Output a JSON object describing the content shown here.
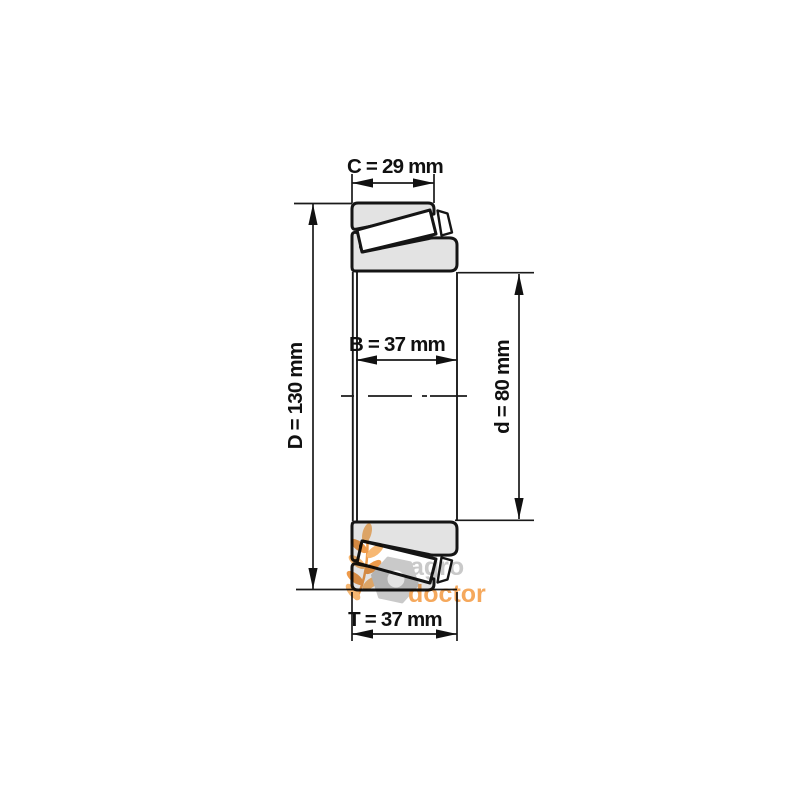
{
  "diagram": {
    "kind": "bearing-cross-section-drawing",
    "dimensions": [
      {
        "id": "C",
        "label": "C = 29 mm",
        "value": 29,
        "unit": "mm",
        "placement": "top"
      },
      {
        "id": "D",
        "label": "D = 130 mm",
        "value": 130,
        "unit": "mm",
        "placement": "left"
      },
      {
        "id": "B",
        "label": "B = 37 mm",
        "value": 37,
        "unit": "mm",
        "placement": "middle"
      },
      {
        "id": "d",
        "label": "d = 80 mm",
        "value": 80,
        "unit": "mm",
        "placement": "right"
      },
      {
        "id": "T",
        "label": "T = 37 mm",
        "value": 37,
        "unit": "mm",
        "placement": "bottom"
      }
    ],
    "watermark": {
      "word1": "agro",
      "word2": "doctor",
      "icons": [
        "wheat-icon",
        "nut-icon"
      ]
    },
    "colors": {
      "background": "#ffffff",
      "ring_fill": "#e3e3e3",
      "outline": "#151515",
      "dimension_line": "#1a1a1a",
      "watermark_gray": "#c9c9c9",
      "watermark_orange": "#f5a85c"
    }
  }
}
